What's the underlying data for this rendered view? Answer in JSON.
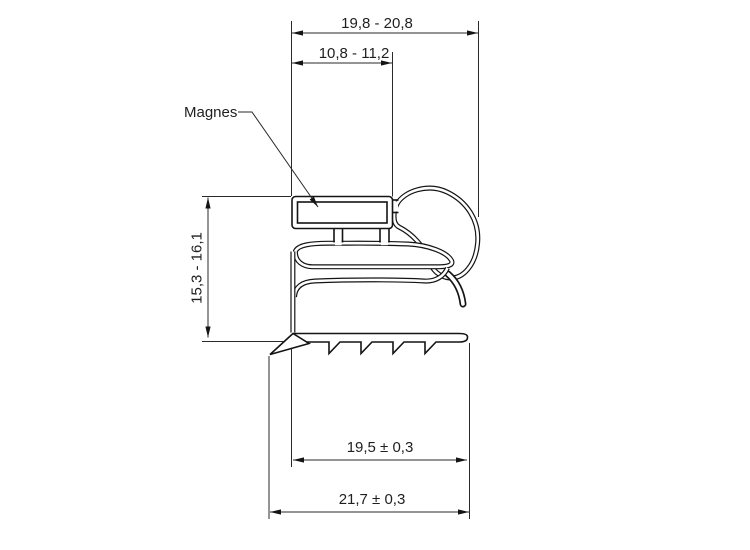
{
  "drawing": {
    "type": "technical-cross-section",
    "subject": "magnetic door gasket profile",
    "labels": {
      "magnet": "Magnes"
    },
    "dimensions": {
      "top_outer_width": "19,8 - 20,8",
      "top_inner_width": "10,8 - 11,2",
      "left_height": "15,3 - 16,1",
      "bottom_inner_width": "19,5 ± 0,3",
      "bottom_outer_width": "21,7 ± 0,3"
    },
    "colors": {
      "line": "#141414",
      "dimension_line": "#2a2a2a",
      "background": "#ffffff",
      "text": "#1f1f1f"
    }
  }
}
